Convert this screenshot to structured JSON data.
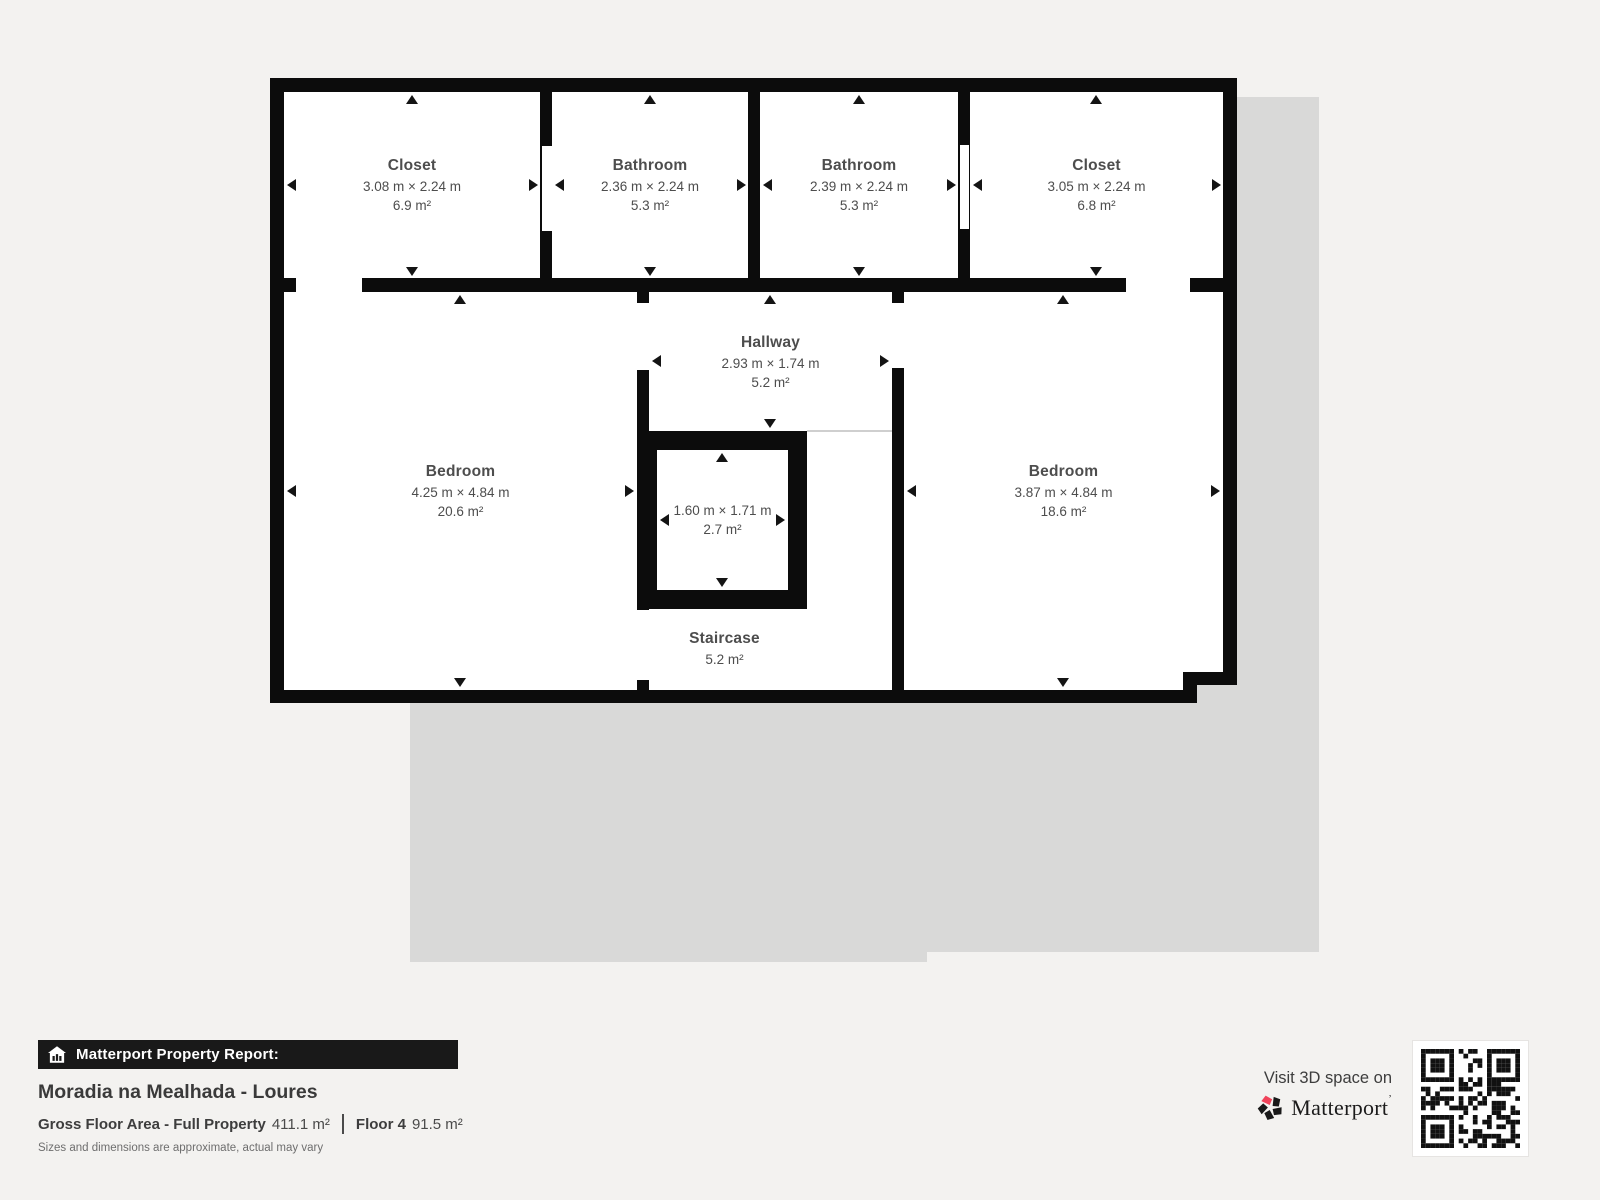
{
  "plan": {
    "rooms": [
      {
        "name": "Closet",
        "dims": "3.08 m × 2.24 m",
        "area": "6.9 m²"
      },
      {
        "name": "Bathroom",
        "dims": "2.36 m × 2.24 m",
        "area": "5.3 m²"
      },
      {
        "name": "Bathroom",
        "dims": "2.39 m × 2.24 m",
        "area": "5.3 m²"
      },
      {
        "name": "Closet",
        "dims": "3.05 m × 2.24 m",
        "area": "6.8 m²"
      },
      {
        "name": "Bedroom",
        "dims": "4.25 m × 4.84 m",
        "area": "20.6 m²"
      },
      {
        "name": "Hallway",
        "dims": "2.93 m × 1.74 m",
        "area": "5.2 m²"
      },
      {
        "name": "",
        "dims": "1.60 m × 1.71 m",
        "area": "2.7 m²"
      },
      {
        "name": "Staircase",
        "dims": "",
        "area": "5.2 m²"
      },
      {
        "name": "Bedroom",
        "dims": "3.87 m × 4.84 m",
        "area": "18.6 m²"
      }
    ]
  },
  "footer": {
    "report_label": "Matterport Property Report:",
    "property_title": "Moradia na Mealhada - Loures",
    "gross_label": "Gross Floor Area - Full Property",
    "gross_value": "411.1 m²",
    "floor_label": "Floor 4",
    "floor_value": "91.5 m²",
    "disclaimer": "Sizes and dimensions are approximate, actual may vary"
  },
  "cta": {
    "visit_text": "Visit 3D space on",
    "brand": "Matterport",
    "brand_mark": "’"
  },
  "colors": {
    "background": "#f3f2f0",
    "wall": "#0c0c0c",
    "shadow": "#d9d9d8",
    "room_text": "#4d4d4d",
    "brand_red": "#f0435a"
  }
}
